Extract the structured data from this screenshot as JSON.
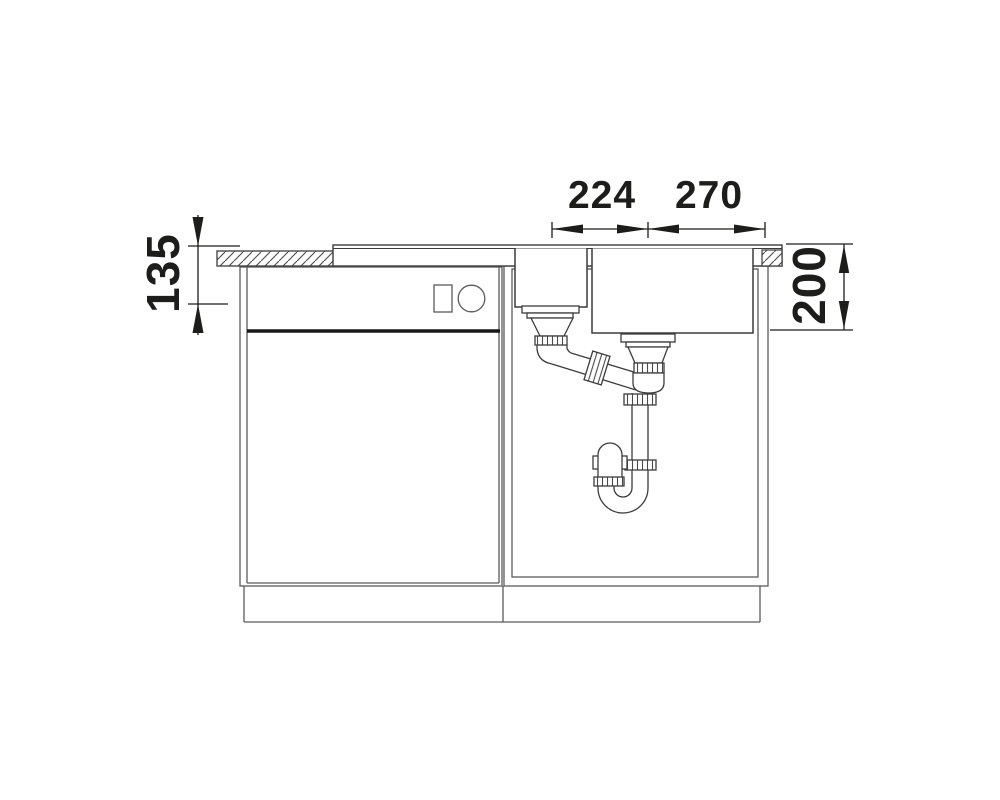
{
  "diagram": {
    "background": "#ffffff",
    "line_color": "#3c3c3c",
    "dimension_color": "#1d1d1b",
    "dimensions": {
      "drain_spacing": "224",
      "drain_to_right_edge": "270",
      "left_depth": "135",
      "bowl_depth": "200"
    }
  }
}
